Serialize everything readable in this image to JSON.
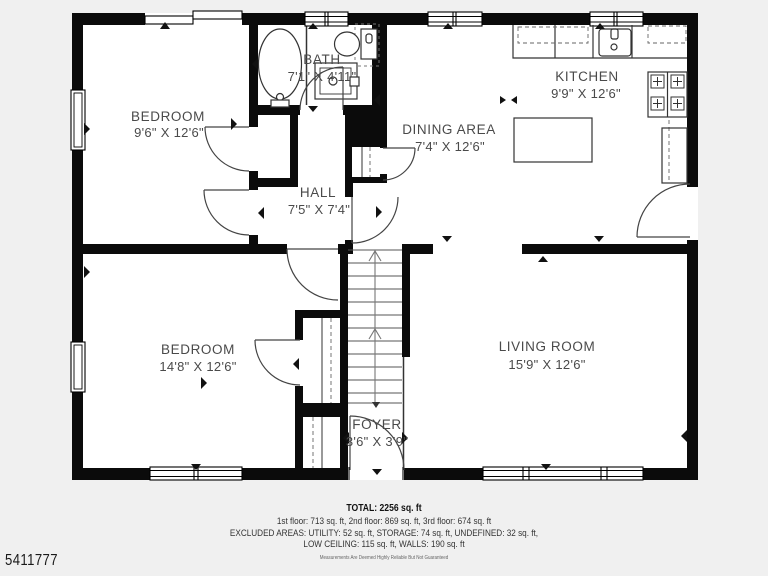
{
  "plate_number": "5411777",
  "colors": {
    "background": "#f0f0f0",
    "floor": "#ffffff",
    "wall": "#0b0b0b",
    "label": "#4a4a4a"
  },
  "rooms": [
    {
      "id": "bedroom-upper",
      "name": "BEDROOM",
      "dims": "9'6\" X 12'6\""
    },
    {
      "id": "bath",
      "name": "BATH",
      "dims": "7'1\" X 4'11\""
    },
    {
      "id": "kitchen",
      "name": "KITCHEN",
      "dims": "9'9\" X 12'6\""
    },
    {
      "id": "dining",
      "name": "DINING AREA",
      "dims": "7'4\" X 12'6\""
    },
    {
      "id": "hall",
      "name": "HALL",
      "dims": "7'5\" X 7'4\""
    },
    {
      "id": "bedroom-lower",
      "name": "BEDROOM",
      "dims": "14'8\" X 12'6\""
    },
    {
      "id": "living",
      "name": "LIVING ROOM",
      "dims": "15'9\" X 12'6\""
    },
    {
      "id": "foyer",
      "name": "FOYER",
      "dims": "3'6\" X 3'9\""
    }
  ],
  "summary": {
    "total": "TOTAL: 2256 sq. ft",
    "floors": "1st floor: 713 sq. ft, 2nd floor: 869 sq. ft, 3rd floor: 674 sq. ft",
    "excluded": "EXCLUDED AREAS: UTILITY: 52 sq. ft, STORAGE: 74 sq. ft, UNDEFINED: 32 sq. ft,",
    "low_ceiling": "LOW CEILING: 115 sq. ft, WALLS: 190 sq. ft"
  },
  "disclaimer": "Measurements Are Deemed Highly Reliable But Not Guaranteed"
}
